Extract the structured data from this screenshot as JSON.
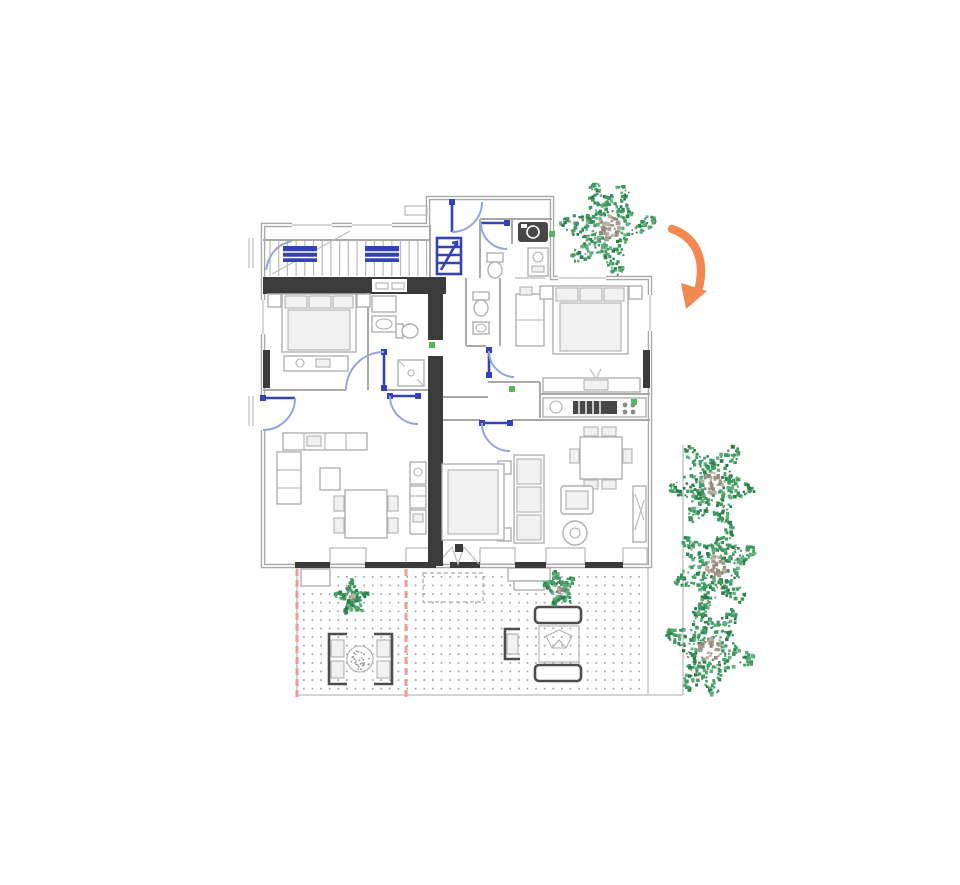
{
  "scene": {
    "type": "architectural-floor-plan",
    "description": "Ground floor plan of a two-unit dwelling with shared staircase, bedrooms, bathrooms, kitchens, living-dining areas, rear terrace with paved grid and outdoor furniture, garden plants along the right side, and a hand-drawn orange direction arrow at the top right"
  },
  "palette": {
    "background": "#ffffff",
    "wall": "#a8a8a8",
    "wallDark": "#3b3b3b",
    "furn": "#b0b0b0",
    "furnFill": "#f1f1f1",
    "appliance": "#474747",
    "doorBlue": "#3342b4",
    "arcBlue": "#93a5dc",
    "accentRed": "#f19a9a",
    "plantGreen": "#3f9a62",
    "plantGreenDark": "#2e7d4c",
    "plantGreenLight": "#63b07c",
    "trunkGray": "#a59d8e",
    "trunkGrayDark": "#8f887b",
    "trunkGrayLight": "#b8b1a2",
    "arrowOrange": "#f28950",
    "pavingDot": "#a3a3a3",
    "outdoorDark": "#4d4d4d",
    "outletGreen": "#5ab55e"
  },
  "plants": {
    "large": [
      {
        "x": 608,
        "y": 228,
        "r": 46
      },
      {
        "x": 712,
        "y": 483,
        "r": 42
      },
      {
        "x": 716,
        "y": 567,
        "r": 42
      },
      {
        "x": 710,
        "y": 650,
        "r": 44
      }
    ],
    "small": [
      {
        "x": 352,
        "y": 597,
        "r": 17
      },
      {
        "x": 560,
        "y": 589,
        "r": 17
      }
    ]
  },
  "terrace": {
    "dots": {
      "x1": 303,
      "y1": 576,
      "x2": 644,
      "y2": 691,
      "spacing": 8.6,
      "size": 1.7
    },
    "red_guides": [
      {
        "x": 297,
        "y1": 569,
        "y2": 698
      },
      {
        "x": 406,
        "y1": 569,
        "y2": 698
      }
    ]
  },
  "stairs": {
    "x1": 270,
    "x2": 427,
    "y1": 241,
    "y2": 276,
    "spacing": 8.7
  },
  "arrow": {
    "path": "M672,229 C698,238 706,263 698,291",
    "head": "686,309 707,291 681,283"
  },
  "outlets": [
    {
      "x": 429,
      "y": 342
    },
    {
      "x": 509,
      "y": 386
    },
    {
      "x": 631,
      "y": 399
    },
    {
      "x": 549,
      "y": 231
    }
  ]
}
